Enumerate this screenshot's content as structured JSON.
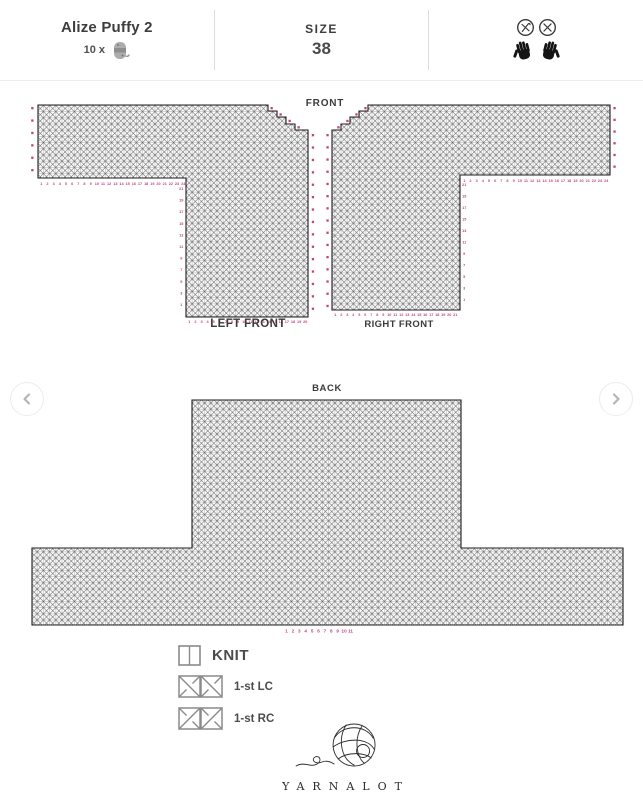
{
  "header": {
    "pattern_name": "Alize Puffy 2",
    "yarn_quantity": "10 x",
    "yarn_icon": "yarn-skein-icon",
    "size_label": "SIZE",
    "size_value": "38",
    "care_icons": [
      "no-crochet-hook-icon",
      "no-knitting-needles-icon",
      "left-hand-icon",
      "right-hand-icon"
    ]
  },
  "carousel": {
    "prev_icon": "chevron-left-icon",
    "next_icon": "chevron-right-icon"
  },
  "chart_data": [
    {
      "type": "knitting-chart",
      "title": "FRONT",
      "marker_color": "#c2437f",
      "grid_line_color": "#5f5f5f",
      "stitch_symbols_used": [
        "knit",
        "1-st LC",
        "1-st RC"
      ],
      "pieces": [
        {
          "label": "LEFT FRONT",
          "sleeve": {
            "stitches": 24,
            "rows": 12
          },
          "body": {
            "stitches": 20,
            "rows": 34
          },
          "neck_steps": 4,
          "numbering": {
            "sleeve_bottom": [
              1,
              2,
              3,
              4,
              5,
              6,
              7,
              8,
              9,
              10,
              11,
              12,
              13,
              14,
              15,
              16,
              17,
              18,
              19,
              20,
              21,
              22,
              23,
              24
            ],
            "body_bottom": [
              1,
              2,
              3,
              4,
              5,
              6,
              7,
              8,
              9,
              10,
              11,
              12,
              13,
              14,
              15,
              16,
              17,
              18,
              19,
              20
            ],
            "body_side": [
              21,
              19,
              17,
              15,
              13,
              11,
              9,
              7,
              5,
              3,
              1
            ],
            "sleeve_side_marks": 6,
            "right_edge_marks": 15,
            "neck_step_marks": 4
          }
        },
        {
          "label": "RIGHT FRONT",
          "mirrored": true,
          "sleeve": {
            "stitches": 24,
            "rows": 12
          },
          "body": {
            "stitches": 21,
            "rows": 34
          },
          "neck_steps": 4,
          "numbering": {
            "sleeve_bottom": [
              1,
              2,
              3,
              4,
              5,
              6,
              7,
              8,
              9,
              10,
              11,
              12,
              13,
              14,
              15,
              16,
              17,
              18,
              19,
              20,
              21,
              22,
              23,
              24
            ],
            "body_bottom": [
              1,
              2,
              3,
              4,
              5,
              6,
              7,
              8,
              9,
              10,
              11,
              12,
              13,
              14,
              15,
              16,
              17,
              18,
              19,
              20,
              21
            ],
            "body_side": [
              21,
              19,
              17,
              15,
              13,
              11,
              9,
              7,
              5,
              3,
              1
            ],
            "sleeve_side_marks": 6,
            "left_edge_marks": 15,
            "neck_step_marks": 4
          }
        }
      ]
    },
    {
      "type": "knitting-chart",
      "title": "BACK",
      "marker_color": "#c2437f",
      "lower_body": {
        "stitches": 95,
        "rows": 12
      },
      "upper_body": {
        "stitches": 43,
        "rows": 24
      },
      "bottom_numbers": [
        1,
        2,
        3,
        4,
        5,
        6,
        7,
        8,
        9,
        10,
        11
      ]
    }
  ],
  "legend": {
    "items": [
      {
        "symbol": "knit-symbol",
        "label": "KNIT"
      },
      {
        "symbol": "left-cross-symbol",
        "label": "1-st LC"
      },
      {
        "symbol": "right-cross-symbol",
        "label": "1-st RC"
      }
    ]
  },
  "footer": {
    "logo": "yarn-ball-logo",
    "brand": "YARNALOT"
  }
}
